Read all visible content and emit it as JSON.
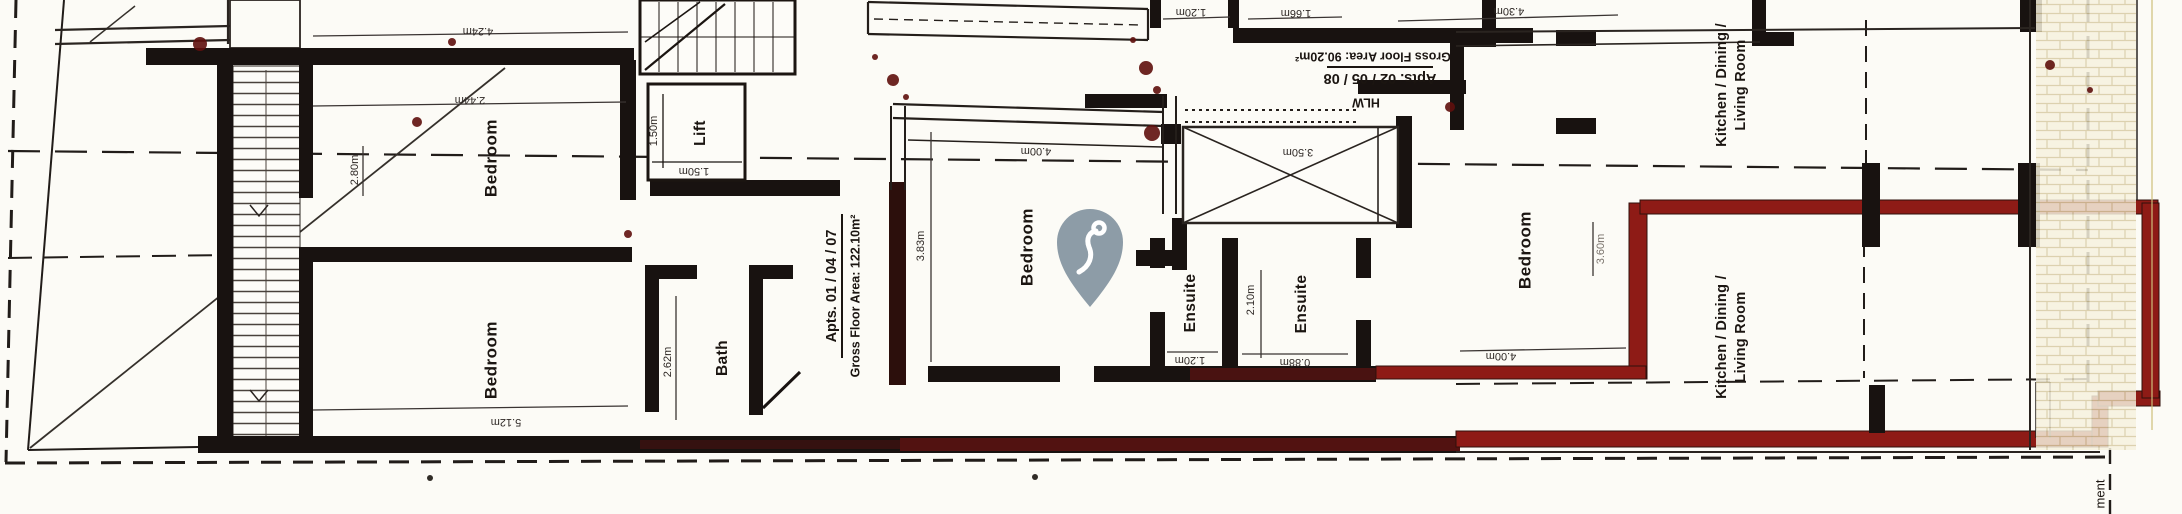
{
  "palette": {
    "paper": "#fcfbf6",
    "ink_wall": "#181210",
    "wall_red": "#8e1b16",
    "pin": "#8d9ca7",
    "hatch_tint": "#d6caa2"
  },
  "apartments": {
    "left": {
      "name": "Apts. 01 / 04 / 07",
      "gross_area": "Gross Floor Area: 122.10m²"
    },
    "middle": {
      "name": "Apts. 02 / 05 / 08",
      "gross_area": "Gross Floor Area: 90.20m²"
    }
  },
  "rooms": {
    "bedroom_left_upper": "Bedroom",
    "bedroom_left_lower": "Bedroom",
    "lift": "Lift",
    "bath": "Bath",
    "bedroom_middle": "Bedroom",
    "ensuite_left": "Ensuite",
    "ensuite_right": "Ensuite",
    "bedroom_right": "Bedroom",
    "kitchen_upper_line1": "Kitchen / Dining /",
    "kitchen_upper_line2": "Living Room",
    "kitchen_lower_line1": "Kitchen / Dining /",
    "kitchen_lower_line2": "Living Room"
  },
  "annotations": {
    "hlw": "HLW",
    "edge_text": "ment"
  },
  "dimensions": {
    "bedroom_left_upper_width": "4.24m",
    "bedroom_left_upper_inner": "2.44m",
    "bedroom_left_upper_depth": "2.80m",
    "bedroom_left_lower_width": "5.12m",
    "lift_width": "1.50m",
    "lift_depth": "1.50m",
    "bath_depth": "2.62m",
    "bedroom_middle_width": "4.00m",
    "bedroom_middle_depth": "3.83m",
    "shaft_width": "3.50m",
    "ensuite_right_depth": "2.10m",
    "ensuite_left_width": "1.20m",
    "ensuite_right_width": "0.88m",
    "top_dim_a": "1.20m",
    "top_dim_b": "1.66m",
    "top_dim_c": "4.30m",
    "bedroom_right_width": "4.00m",
    "bedroom_right_depth": "3.60m"
  },
  "marker": {
    "kind": "map-pin",
    "color": "#8d9ca7"
  }
}
